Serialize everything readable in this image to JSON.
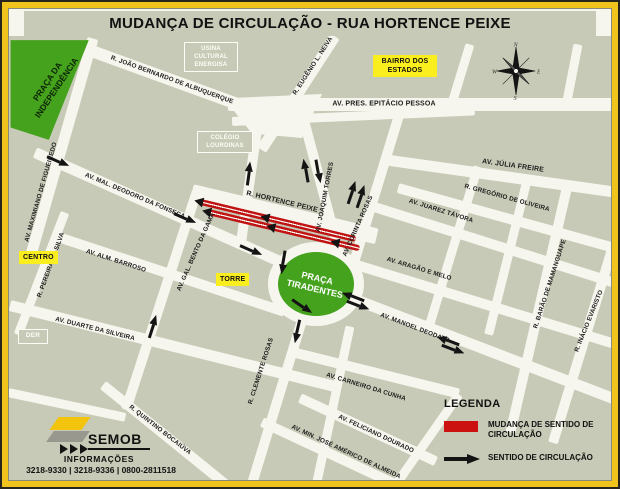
{
  "title": "MUDANÇA DE CIRCULAÇÃO - RUA HORTENCE PEIXE",
  "colors": {
    "border_yellow": "#f0c41c",
    "block_gray_green": "#c7cab6",
    "road_white": "#f7f6ee",
    "praca_green": "#45a21d",
    "label_yellow": "#faee1f",
    "change_red": "#cc1111",
    "arrow_black": "#141414"
  },
  "roads": [
    "R. JOÃO BERNARDO DE ALBUQUERQUE",
    "R. EUGÊNIO L. NEIVA",
    "AV. PRES. EPITÁCIO PESSOA",
    "AV. JÚLIA FREIRE",
    "R. GREGÓRIO DE OLIVEIRA",
    "AV. JUAREZ TÁVORA",
    "AV. ARAGÃO E MELO",
    "AV. MAXIMIANO DE FIGUEIREDO",
    "AV. MAL. DEODORO DA FONSECA",
    "AV. ALM. BARROSO",
    "R. PEREIRA DA SILVA",
    "AV. GAL. BENTO DA GAMA",
    "R. HORTENCE PEIXE",
    "AV. JOAQUIM TORRES",
    "AV. CORINTA ROSAS",
    "AV. DUARTE DA SILVEIRA",
    "R. CLEMENTE ROSAS",
    "AV. MANOEL DEODATO",
    "AV. CARNEIRO DA CUNHA",
    "AV. FELICIANO DOURADO",
    "AV. MIN. JOSÉ AMÉRICO DE ALMEIDA",
    "R. QUINTINO BOCAIÚVA",
    "R. BARÃO DE MAMANGUAPE",
    "R. INÁCIO EVARISTO"
  ],
  "places": {
    "independencia": "PRAÇA DA INDEPENDÊNCIA",
    "tiradentes": "PRAÇA TIRADENTES",
    "usina": "USINA CULTURAL ENERGISA",
    "colegio": "COLÉGIO LOURDINAS",
    "bairro": "BAIRRO DOS ESTADOS",
    "centro": "CENTRO",
    "torre": "TORRE",
    "der": "DER"
  },
  "compass": {
    "n": "N",
    "s": "S",
    "e": "E",
    "w": "W"
  },
  "legend": {
    "title": "LEGENDA",
    "items": [
      {
        "symbol": "red-bar",
        "label": "MUDANÇA DE SENTIDO DE CIRCULAÇÃO"
      },
      {
        "symbol": "black-arrow",
        "label": "SENTIDO DE CIRCULAÇÃO"
      }
    ]
  },
  "footer": {
    "brand": "SEMOB",
    "info": "INFORMAÇÕES",
    "phones": "3218-9330 | 3218-9336 | 0800-2811518"
  }
}
